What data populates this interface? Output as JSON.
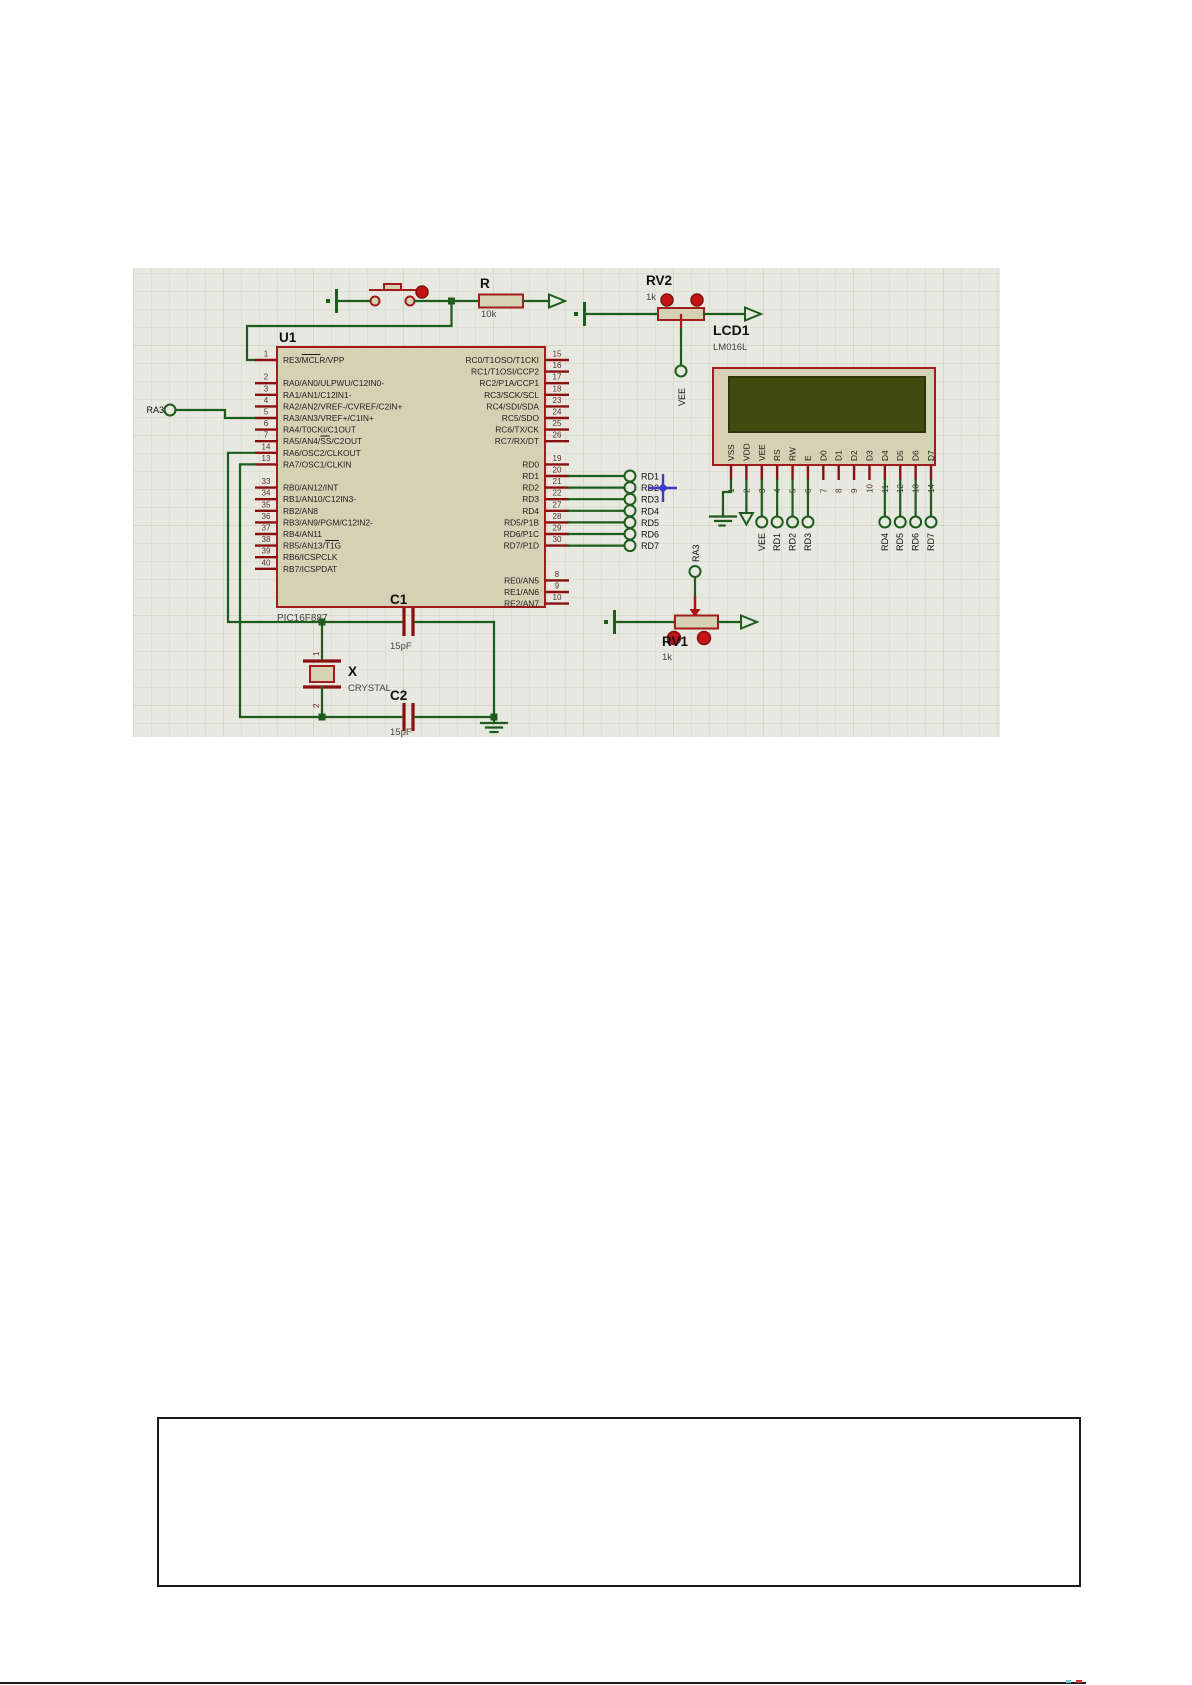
{
  "schematic": {
    "mcu": {
      "ref": "U1",
      "part": "PIC16F887",
      "left_pins": [
        {
          "num": "1",
          "name": "RE3/MCLR/VPP",
          "row": 0
        },
        {
          "num": "2",
          "name": "RA0/AN0/ULPWU/C12IN0-",
          "row": 2
        },
        {
          "num": "3",
          "name": "RA1/AN1/C12IN1-",
          "row": 3
        },
        {
          "num": "4",
          "name": "RA2/AN2/VREF-/CVREF/C2IN+",
          "row": 4
        },
        {
          "num": "5",
          "name": "RA3/AN3/VREF+/C1IN+",
          "row": 5
        },
        {
          "num": "6",
          "name": "RA4/T0CKI/C1OUT",
          "row": 6
        },
        {
          "num": "7",
          "name": "RA5/AN4/SS/C2OUT",
          "row": 7
        },
        {
          "num": "14",
          "name": "RA6/OSC2/CLKOUT",
          "row": 8
        },
        {
          "num": "13",
          "name": "RA7/OSC1/CLKIN",
          "row": 9
        },
        {
          "num": "33",
          "name": "RB0/AN12/INT",
          "row": 11
        },
        {
          "num": "34",
          "name": "RB1/AN10/C12IN3-",
          "row": 12
        },
        {
          "num": "35",
          "name": "RB2/AN8",
          "row": 13
        },
        {
          "num": "36",
          "name": "RB3/AN9/PGM/C12IN2-",
          "row": 14
        },
        {
          "num": "37",
          "name": "RB4/AN11",
          "row": 15
        },
        {
          "num": "38",
          "name": "RB5/AN13/T1G",
          "row": 16
        },
        {
          "num": "39",
          "name": "RB6/ICSPCLK",
          "row": 17
        },
        {
          "num": "40",
          "name": "RB7/ICSPDAT",
          "row": 18
        }
      ],
      "right_pins": [
        {
          "num": "15",
          "name": "RC0/T1OSO/T1CKI",
          "row": 0
        },
        {
          "num": "16",
          "name": "RC1/T1OSI/CCP2",
          "row": 1
        },
        {
          "num": "17",
          "name": "RC2/P1A/CCP1",
          "row": 2
        },
        {
          "num": "18",
          "name": "RC3/SCK/SCL",
          "row": 3
        },
        {
          "num": "23",
          "name": "RC4/SDI/SDA",
          "row": 4
        },
        {
          "num": "24",
          "name": "RC5/SDO",
          "row": 5
        },
        {
          "num": "25",
          "name": "RC6/TX/CK",
          "row": 6
        },
        {
          "num": "26",
          "name": "RC7/RX/DT",
          "row": 7
        },
        {
          "num": "19",
          "name": "RD0",
          "row": 9
        },
        {
          "num": "20",
          "name": "RD1",
          "row": 10
        },
        {
          "num": "21",
          "name": "RD2",
          "row": 11
        },
        {
          "num": "22",
          "name": "RD3",
          "row": 12
        },
        {
          "num": "27",
          "name": "RD4",
          "row": 13
        },
        {
          "num": "28",
          "name": "RD5/P1B",
          "row": 14
        },
        {
          "num": "29",
          "name": "RD6/P1C",
          "row": 15
        },
        {
          "num": "30",
          "name": "RD7/P1D",
          "row": 16
        },
        {
          "num": "8",
          "name": "RE0/AN5",
          "row": 19
        },
        {
          "num": "9",
          "name": "RE1/AN6",
          "row": 20
        },
        {
          "num": "10",
          "name": "RE2/AN7",
          "row": 21
        }
      ]
    },
    "lcd": {
      "ref": "LCD1",
      "part": "LM016L",
      "pins": [
        {
          "num": "1",
          "name": "VSS"
        },
        {
          "num": "2",
          "name": "VDD"
        },
        {
          "num": "3",
          "name": "VEE"
        },
        {
          "num": "4",
          "name": "RS"
        },
        {
          "num": "5",
          "name": "RW"
        },
        {
          "num": "6",
          "name": "E"
        },
        {
          "num": "7",
          "name": "D0"
        },
        {
          "num": "8",
          "name": "D1"
        },
        {
          "num": "9",
          "name": "D2"
        },
        {
          "num": "10",
          "name": "D3"
        },
        {
          "num": "11",
          "name": "D4"
        },
        {
          "num": "12",
          "name": "D5"
        },
        {
          "num": "13",
          "name": "D6"
        },
        {
          "num": "14",
          "name": "D7"
        }
      ]
    },
    "resistor": {
      "ref": "R",
      "value": "10k"
    },
    "rv2": {
      "ref": "RV2",
      "value": "1k"
    },
    "rv1": {
      "ref": "RV1",
      "value": "1k"
    },
    "crystal": {
      "ref": "X",
      "part": "CRYSTAL",
      "pin1": "1",
      "pin2": "2"
    },
    "c1": {
      "ref": "C1",
      "value": "15pF"
    },
    "c2": {
      "ref": "C2",
      "value": "15pF"
    },
    "terminals": {
      "ra3_left": "RA3",
      "vee_rv2": "VEE",
      "ra3_rv1": "RA3",
      "lcd_below": [
        "VEE",
        "RD1",
        "RD2",
        "RD3",
        "RD4",
        "RD5",
        "RD6",
        "RD7"
      ],
      "chip_rd": [
        "RD1",
        "RD2",
        "RD3",
        "RD4",
        "RD5",
        "RD6",
        "RD7"
      ]
    },
    "colors": {
      "wire": "#1d5c1d",
      "component": "#a21c1c",
      "pin_stub": "#8a1010",
      "body_fill": "#d5d1b5",
      "screen": "#414b10",
      "grid_bg": "#e7e8e0",
      "red_dot": "#c41414"
    }
  }
}
